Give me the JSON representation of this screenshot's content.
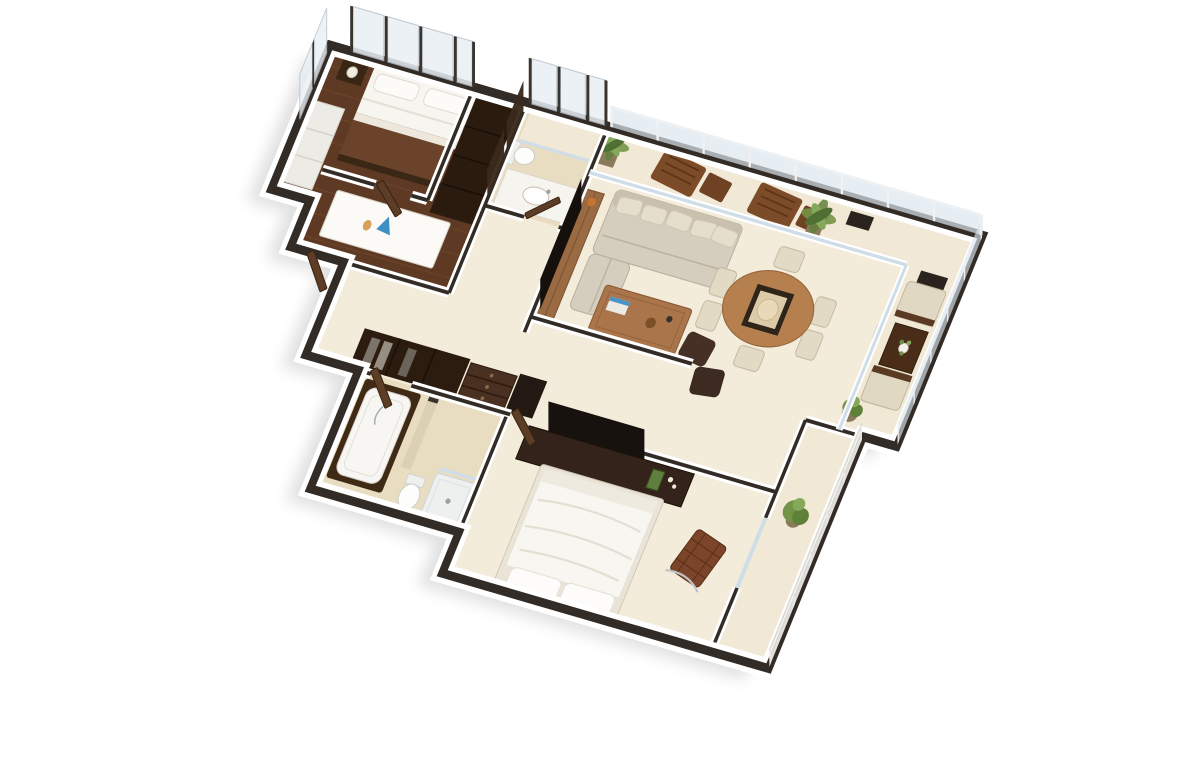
{
  "scene": {
    "type": "3d-floor-plan-render",
    "view": "isometric aerial view, plan rotated clockwise ~17 degrees",
    "style": "photorealistic architectural visualization, two-bedroom apartment, no text or labels visible",
    "background": "#ffffff"
  },
  "palette": {
    "bg": "#ffffff",
    "wall-dark": "#332c26",
    "wall-face": "#ffffff",
    "floor-cream": "#f4ecdb",
    "floor-deck": "#f1e8d6",
    "floor-wood": "#5e3a24",
    "wood-plank-line": "#74492d",
    "tile": "#e9ddc1",
    "tile-light": "#f1e9d5",
    "glass": "#dce6ee",
    "glass-frame": "#b9c2cb",
    "sofa-beige": "#d5cebe",
    "cushion": "#e5decd",
    "wood-mid": "#9a6a42",
    "wood-coffee": "#aa754b",
    "wood-dining": "#b5804e",
    "wood-deck-chair": "#7c4b28",
    "dark-wood": "#2b1b0e",
    "dark-wood-2": "#42) ",
    "ottoman-brown": "#463026",
    "leather-brown": "#7a452a",
    "blanket-brown": "#6b432a",
    "linen-white": "#f8f6f1",
    "plant-green": "#739447",
    "plant-green-dark": "#4f6f33",
    "gold": "#b98a3c",
    "accent-orange": "#c8742f",
    "accent-blue": "#3f8fc4",
    "shadow": "rgba(0,0,0,0.12)"
  },
  "rooms": [
    {
      "name": "master-bedroom",
      "floor": "dark-wood",
      "furniture": [
        "double-bed with brown blanket and white sheets",
        "dark headboard",
        "nightstand",
        "table-lamp",
        "white bench seat",
        "storage cabinet",
        "floor-to-ceiling windows"
      ]
    },
    {
      "name": "study-nook",
      "floor": "dark-wood",
      "furniture": [
        "white desk",
        "blue decor object",
        "orange decor object"
      ]
    },
    {
      "name": "dressing-corridor",
      "floor": "dark-wood",
      "furniture": [
        "tall dark wardrobe",
        "leaning wardrobe door panels"
      ]
    },
    {
      "name": "bathroom-1",
      "floor": "beige-tile",
      "furniture": [
        "glass shower",
        "vanity with basin",
        "toilet"
      ]
    },
    {
      "name": "living-room",
      "floor": "cream",
      "furniture": [
        "tv console",
        "flat-screen tv",
        "beige l-shaped sofa with five back pillows",
        "wood coffee table",
        "magazine",
        "two dark brown ottomans"
      ]
    },
    {
      "name": "dining-area",
      "floor": "cream",
      "furniture": [
        "oval wood dining table",
        "dark centerpiece tray with round platter",
        "six beige upholstered chairs"
      ]
    },
    {
      "name": "balcony-north",
      "floor": "deck-cream",
      "furniture": [
        "glass railing",
        "two wooden lounge chairs",
        "two wooden side tables",
        "two potted palms",
        "dark floor mat"
      ]
    },
    {
      "name": "balcony-nook",
      "floor": "deck-cream",
      "furniture": [
        "two beige cube armchairs",
        "dark wood side table",
        "flower vase",
        "potted plant",
        "dark floor mat",
        "glass divider"
      ]
    },
    {
      "name": "hallway",
      "floor": "cream",
      "furniture": [
        "dark wardrobe closet with hanging clothes",
        "drawer chest",
        "dark pantry cabinet",
        "open doors"
      ]
    },
    {
      "name": "bedroom-2",
      "floor": "cream",
      "furniture": [
        "dark dresser tv-unit",
        "wall tv",
        "white double bed with pillows",
        "two gold wall sconces",
        "brown barcelona-style leather chair"
      ]
    },
    {
      "name": "bathroom-2",
      "floor": "beige-tile",
      "furniture": [
        "bathtub with dark wood surround",
        "handheld faucet",
        "toilet",
        "shower tray",
        "tiled partition"
      ]
    },
    {
      "name": "balcony-bedroom-2",
      "floor": "deck-cream",
      "furniture": [
        "white rail fence with posts",
        "potted green plant"
      ]
    }
  ],
  "openings": {
    "doors_open_brown": 5,
    "window_walls": [
      "master-bedroom north",
      "bathroom-1 north",
      "master-bedroom west"
    ],
    "glass_railings": [
      "balcony north edge",
      "balcony east edge",
      "bedroom-2 balcony east edge"
    ]
  }
}
